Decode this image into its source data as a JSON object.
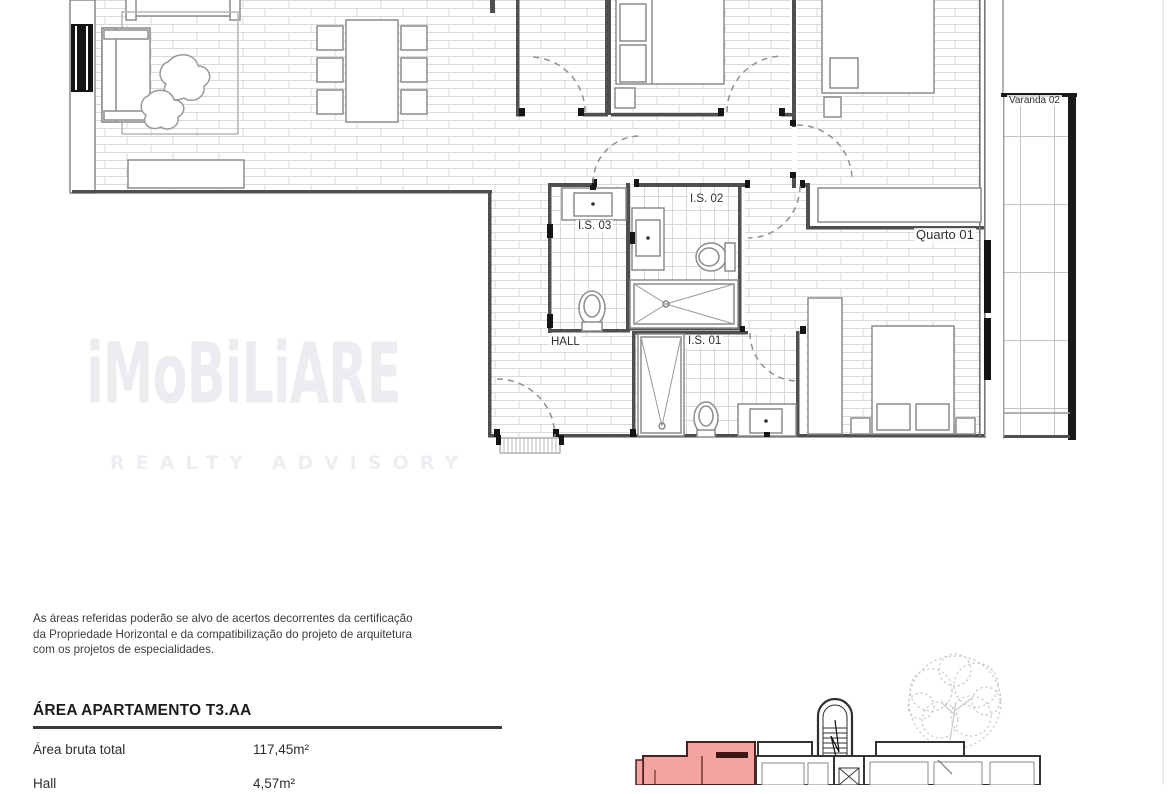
{
  "floorplan": {
    "labels": {
      "is03": "I.S. 03",
      "is02": "I.S. 02",
      "is01": "I.S. 01",
      "hall": "HALL",
      "quarto01": "Quarto 01",
      "varanda02": "Varanda 02"
    }
  },
  "watermark": {
    "brand": "iMoBiLiARE",
    "tagline": "REALTY ADVISORY"
  },
  "disclaimer": {
    "line1": "As áreas referidas poderão se alvo de acertos decorrentes da certificação",
    "line2": "da Propriedade Horizontal e da compatibilização do projeto de arquitetura",
    "line3": "com os projetos de especialidades."
  },
  "area_table": {
    "title": "ÁREA APARTAMENTO T3.AA",
    "rows": [
      {
        "label": "Área bruta total",
        "value": "117,45m²"
      },
      {
        "label": "Hall",
        "value": "4,57m²"
      }
    ]
  },
  "colors": {
    "highlighted_unit_fill": "#f2a4a1",
    "highlighted_unit_wall": "#4a1f1c",
    "plan_walls": "#4f4f4f",
    "watermark": "#ecedf0"
  }
}
